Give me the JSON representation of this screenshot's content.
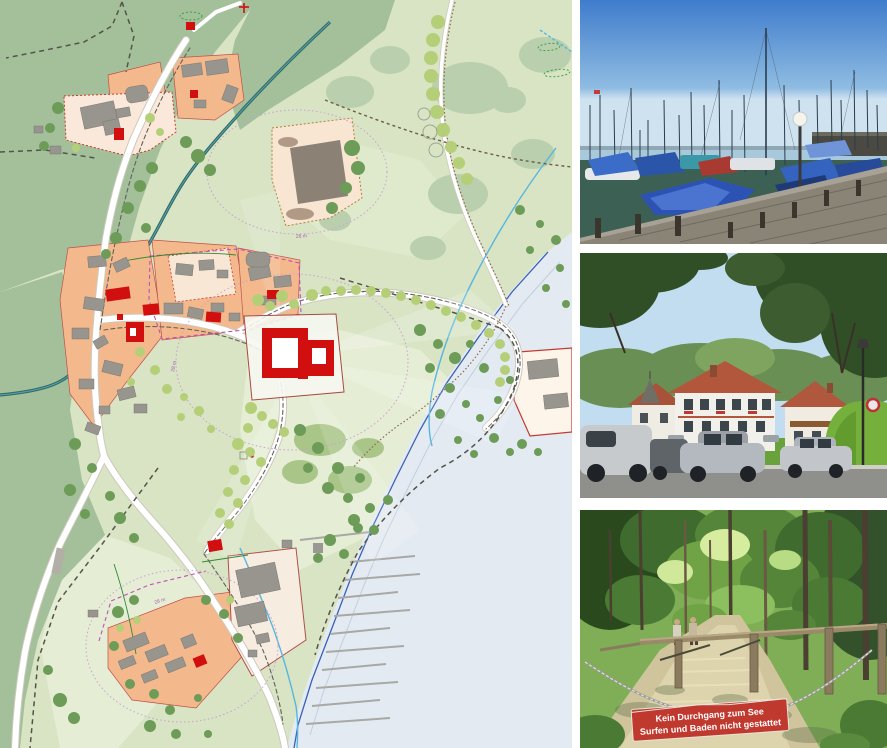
{
  "figure": {
    "background": "#ffffff"
  },
  "map": {
    "name": "lakeside-village-site-plan",
    "annotations": [
      {
        "id": "measure-label-1",
        "text": "28 m"
      },
      {
        "id": "measure-label-2",
        "text": "28 m"
      },
      {
        "id": "measure-label-3",
        "text": "28 m"
      }
    ],
    "palette": {
      "meadow": "#d8e4c4",
      "meadow_light": "#e5edd5",
      "forest": "#a3c09b",
      "canopy": "#b9cfad",
      "lake": "#e3eaf2",
      "parcel_orange": "#f3b98c",
      "parcel_cream": "#fae9da",
      "building_gray": "#97958e",
      "building_red": "#d10f0f",
      "road": "#ffffff",
      "stream": "#2e6e62",
      "creek": "#58b6de",
      "shore_line": "#3a62b8",
      "boundary_dark": "#55534a",
      "boundary_magenta": "#c050b8",
      "boundary_purple": "#c9a0d6",
      "path_brown": "#8a6a4e",
      "hedge_green": "#2f8a33",
      "tree_dark": "#6d9b58",
      "tree_light": "#b5cf78"
    }
  },
  "photos": {
    "marina": {
      "name": "marina-sailboats-photo"
    },
    "village_street": {
      "name": "village-street-houses-photo"
    },
    "forest_path": {
      "name": "forest-path-photo",
      "sign": {
        "line1": "Kein Durchgang zum See",
        "line2": "Surfen und Baden nicht gestattet",
        "bg": "#c0392f",
        "text_color": "#ffffff"
      }
    }
  }
}
